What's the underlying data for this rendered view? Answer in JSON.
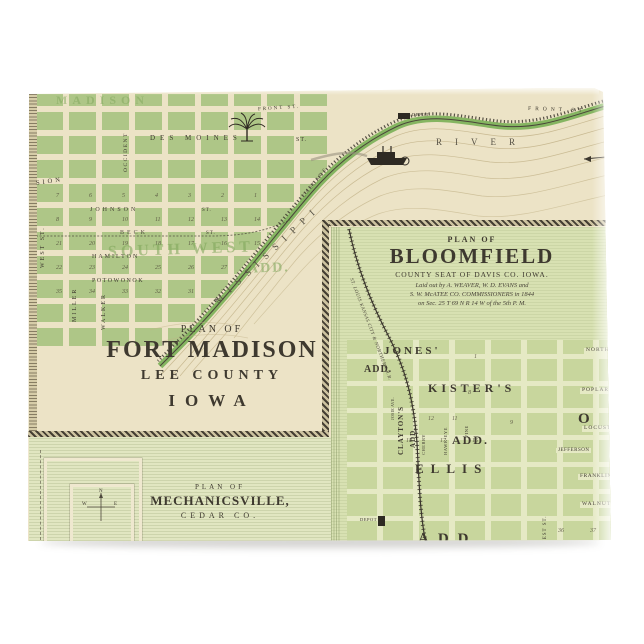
{
  "colors": {
    "card_base": "#ece3c6",
    "block_green": "#aec687",
    "bloomfield_bg": "#d8e1b2",
    "ink": "#3e392f",
    "shore_green": "#7fb25c"
  },
  "fort_madison": {
    "plan_of": "PLAN OF",
    "title": "FORT MADISON",
    "county": "LEE COUNTY",
    "state": "IOWA",
    "additions": {
      "madison": "MADISON",
      "south_west": "SOUTH WEST",
      "south_west_add": "ADD."
    },
    "streets": {
      "front": "FRONT ST.",
      "des_moines": "DES MOINES",
      "st": "ST.",
      "division": "SION",
      "johnson": "JOHNSON",
      "beck": "BECK",
      "hamilton": "HAMILTON",
      "potowonok": "POTOWONOK",
      "west": "WEST ST.",
      "miller": "MILLER",
      "walker": "WALKER",
      "occident": "OCCIDENT"
    },
    "river": {
      "mississippi": "MISSISSIPPI",
      "river": "RIVER",
      "cascade": "CASCADE"
    },
    "depot": "DEPOT",
    "block_rows": [
      [
        "7",
        "6",
        "5",
        "4",
        "3",
        "2",
        "1"
      ],
      [
        "8",
        "9",
        "10",
        "11",
        "12",
        "13",
        "14"
      ],
      [
        "21",
        "20",
        "19",
        "18",
        "17",
        "16",
        "15"
      ],
      [
        "22",
        "23",
        "24",
        "25",
        "26",
        "27",
        "28"
      ],
      [
        "35",
        "34",
        "33",
        "32",
        "31",
        "30",
        "29"
      ]
    ]
  },
  "bloomfield": {
    "plan_of": "PLAN OF",
    "title": "BLOOMFIELD",
    "subtitle": "COUNTY SEAT OF DAVIS CO. IOWA.",
    "note1": "Laid out by A. WEAVER, W. D. EVANS and",
    "note2": "S. W. McATEE CO. COMMISSIONERS in 1844",
    "note3": "on Sec. 25 T 69 N R 14 W of the 5th P. M.",
    "railroad": "ST. LOUIS KANSAS CITY & NORTHERN R.R.",
    "additions": {
      "jones": "JONES'",
      "jones_add": "ADD.",
      "kisters": "KISTER'S",
      "kisters_add": "ADD.",
      "claytons": "CLAYTON'S",
      "claytons_add": "ADD.",
      "ellis": "ELLIS",
      "bottom_add": "ADD",
      "big_o": "O"
    },
    "streets": {
      "north": "NORTH",
      "poplar": "POPLAR",
      "locust": "LOCUST",
      "jefferson": "JEFFERSON",
      "franklin": "FRANKLIN",
      "walnut": "WALNUT",
      "west": "WEST ST.",
      "cherry": "CHERRY",
      "hawkeye": "HAWK-EYE",
      "vine": "VINE",
      "josie": "JOSIE AVE."
    },
    "depot": "DEPOT",
    "block_numbers": [
      "1",
      "8",
      "9",
      "11",
      "12",
      "18",
      "17",
      "16",
      "36",
      "37"
    ]
  },
  "mechanicsville": {
    "plan_of": "PLAN OF",
    "title": "MECHANICSVILLE,",
    "county": "CEDAR CO.",
    "compass_n": "N",
    "compass_w": "W",
    "compass_e": "E"
  }
}
